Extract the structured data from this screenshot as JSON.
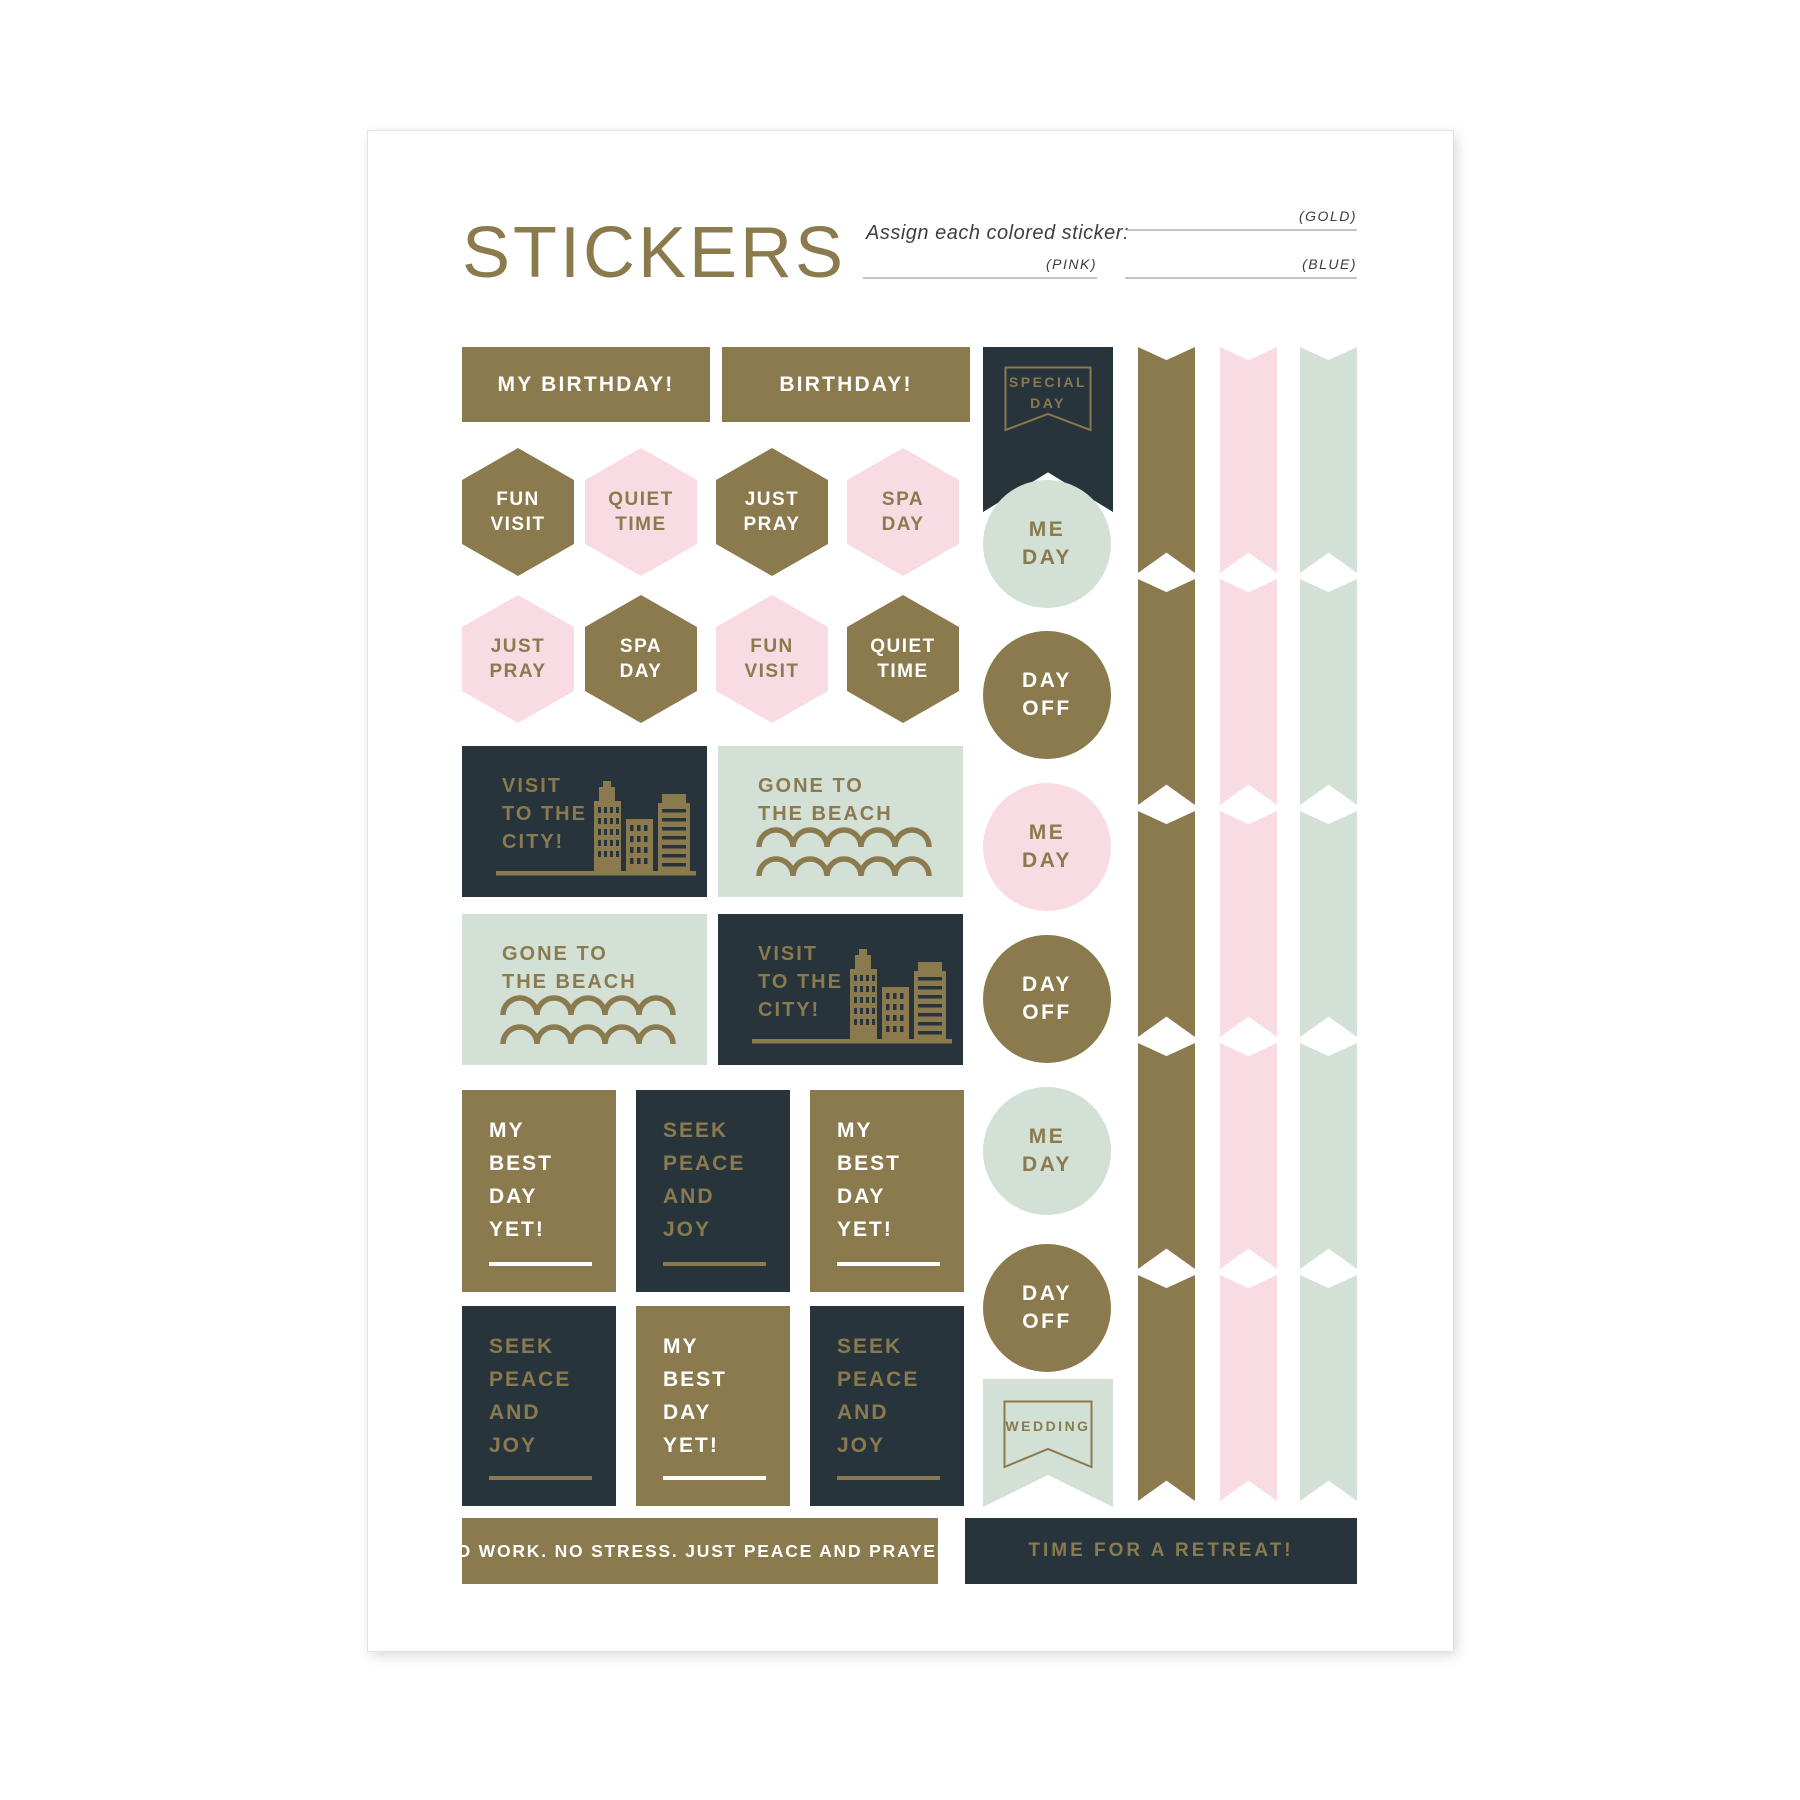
{
  "colors": {
    "gold": "#8a7a4d",
    "pink": "#f9dce3",
    "mint": "#d2e0d6",
    "dark": "#28343c",
    "line_gray": "#c3c3c3",
    "title_gold": "#8a7a4c",
    "text_dark": "#3f3f3f"
  },
  "header": {
    "title": "STICKERS",
    "assign_prompt": "Assign each colored sticker:",
    "gold_label": "(GOLD)",
    "pink_label": "(PINK)",
    "blue_label": "(BLUE)"
  },
  "row1": {
    "sticker1": "MY BIRTHDAY!",
    "sticker2": "BIRTHDAY!"
  },
  "special_banner": {
    "line1": "SPECIAL",
    "line2": "DAY"
  },
  "hexes": [
    {
      "line1": "FUN",
      "line2": "VISIT"
    },
    {
      "line1": "QUIET",
      "line2": "TIME"
    },
    {
      "line1": "JUST",
      "line2": "PRAY"
    },
    {
      "line1": "SPA",
      "line2": "DAY"
    },
    {
      "line1": "JUST",
      "line2": "PRAY"
    },
    {
      "line1": "SPA",
      "line2": "DAY"
    },
    {
      "line1": "FUN",
      "line2": "VISIT"
    },
    {
      "line1": "QUIET",
      "line2": "TIME"
    }
  ],
  "scenes": {
    "city": {
      "line1": "VISIT",
      "line2": "TO THE",
      "line3": "CITY!"
    },
    "beach": {
      "line1": "GONE TO",
      "line2": "THE BEACH"
    }
  },
  "squares": {
    "best": {
      "line1": "MY",
      "line2": "BEST",
      "line3": "DAY",
      "line4": "YET!"
    },
    "peace": {
      "line1": "SEEK",
      "line2": "PEACE",
      "line3": "AND",
      "line4": "JOY"
    }
  },
  "circles": [
    {
      "line1": "ME",
      "line2": "DAY"
    },
    {
      "line1": "DAY",
      "line2": "OFF"
    },
    {
      "line1": "ME",
      "line2": "DAY"
    },
    {
      "line1": "DAY",
      "line2": "OFF"
    },
    {
      "line1": "ME",
      "line2": "DAY"
    },
    {
      "line1": "DAY",
      "line2": "OFF"
    }
  ],
  "wedding_banner": {
    "label": "WEDDING"
  },
  "bars": {
    "gold_bar": "NO WORK. NO STRESS. JUST PEACE AND PRAYER.",
    "dark_bar": "TIME FOR A RETREAT!"
  }
}
